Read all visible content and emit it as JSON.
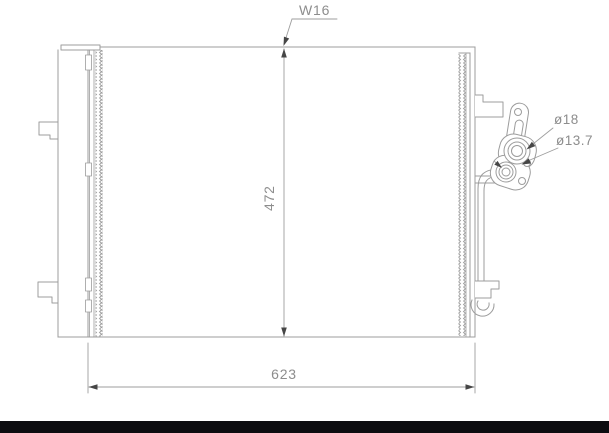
{
  "diagram": {
    "labels": {
      "tube_width": "W16",
      "core_height": "472",
      "overall_width": "623",
      "port_large_diameter": "ø18",
      "port_small_diameter": "ø13.7"
    },
    "colors": {
      "background": "#ffffff",
      "line": "#9c9c9c",
      "dimension_line": "#9e9e9e",
      "arrow": "#464646",
      "text": "#8d8d8d",
      "bottom_bar": "#0c0c10"
    }
  }
}
